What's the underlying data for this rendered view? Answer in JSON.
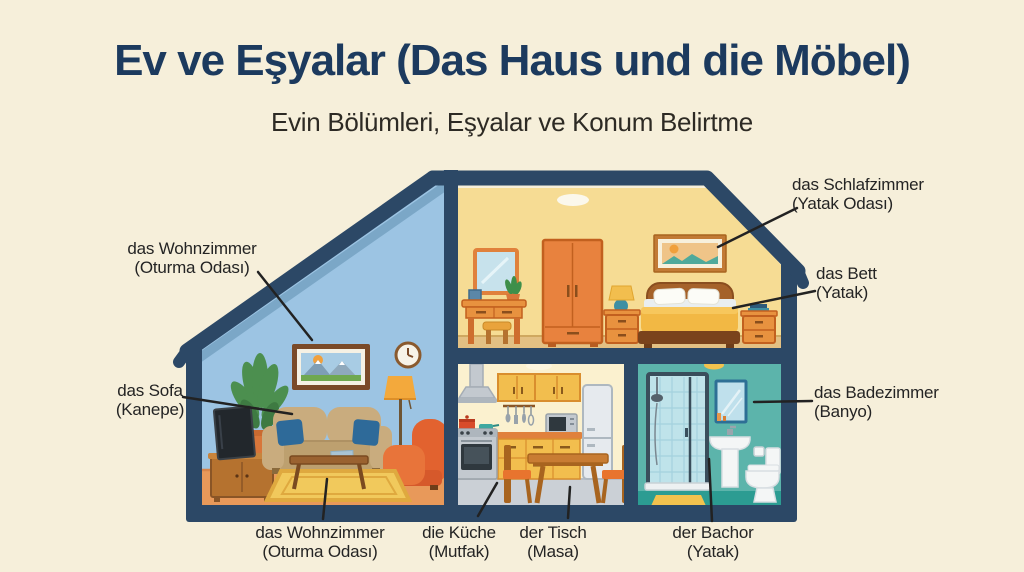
{
  "header": {
    "title": "Ev ve Eşyalar (Das Haus und die Möbel)",
    "subtitle": "Evin Bölümleri, Eşyalar ve Konum Belirtme"
  },
  "labels": {
    "wohnzimmer_top": {
      "term": "das Wohnzimmer",
      "translation": "(Oturma Odası)"
    },
    "schlafzimmer": {
      "term": "das Schlafzimmer",
      "translation": "(Yatak Odası)"
    },
    "bett": {
      "term": "das Bett",
      "translation": "(Yatak)"
    },
    "sofa": {
      "term": "das Sofa",
      "translation": "(Kanepe)"
    },
    "badezimmer": {
      "term": "das Badezimmer",
      "translation": "(Banyo)"
    },
    "wohnzimmer_bottom": {
      "term": "das Wohnzimmer",
      "translation": "(Oturma Odası)"
    },
    "kueche": {
      "term": "die Küche",
      "translation": "(Mutfak)"
    },
    "tisch": {
      "term": "der Tisch",
      "translation": "(Masa)"
    },
    "bachor": {
      "term": "der Bachor",
      "translation": "(Yatak)"
    }
  },
  "colors": {
    "background": "#F6EFDA",
    "title_navy": "#1C3A5E",
    "structure_navy": "#2C4866",
    "living_room_wall": "#9CC4E3",
    "bedroom_wall": "#F6DC94",
    "kitchen_wall": "#FBF1CF",
    "bathroom_wall": "#5CB4AB",
    "furniture_orange": "#E8823E",
    "label_text": "#242424"
  }
}
